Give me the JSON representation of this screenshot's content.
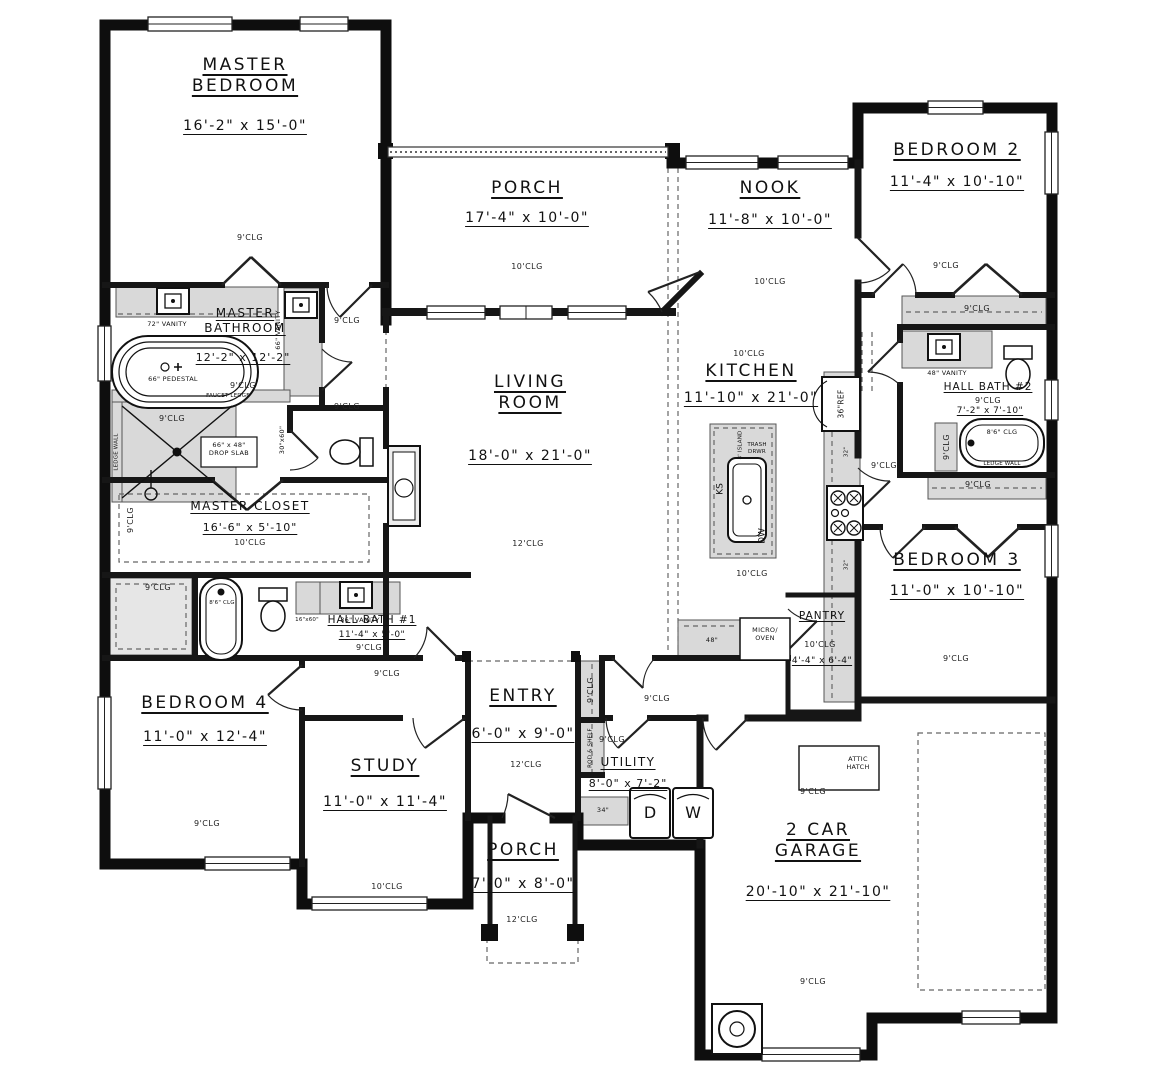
{
  "rooms": {
    "master_bedroom": {
      "name": "MASTER BEDROOM",
      "dims": "16'-2\" x 15'-0\"",
      "clg": "9'CLG"
    },
    "porch_top": {
      "name": "PORCH",
      "dims": "17'-4\" x 10'-0\"",
      "clg": "10'CLG"
    },
    "nook": {
      "name": "NOOK",
      "dims": "11'-8\" x 10'-0\"",
      "clg": "10'CLG"
    },
    "bedroom2": {
      "name": "BEDROOM 2",
      "dims": "11'-4\" x 10'-10\"",
      "clg": "9'CLG"
    },
    "master_bathroom": {
      "name": "MASTER BATHROOM",
      "dims": "12'-2\" x 12'-2\"",
      "clg": "9'CLG"
    },
    "living_room": {
      "name": "LIVING ROOM",
      "dims": "18'-0\" x 21'-0\"",
      "clg": "12'CLG"
    },
    "kitchen": {
      "name": "KITCHEN",
      "dims": "11'-10\" x 21'-0\"",
      "clg": "10'CLG"
    },
    "hall_bath2": {
      "name": "HALL BATH #2",
      "dims": "7'-2\" x 7'-10\"",
      "clg": "9'CLG"
    },
    "master_closet": {
      "name": "MASTER CLOSET",
      "dims": "16'-6\" x 5'-10\"",
      "clg": "10'CLG"
    },
    "bedroom3": {
      "name": "BEDROOM 3",
      "dims": "11'-0\" x 10'-10\"",
      "clg": "9'CLG"
    },
    "hall_bath1": {
      "name": "HALL BATH #1",
      "dims": "11'-4\" x 5'-0\"",
      "clg": "9'CLG"
    },
    "bedroom4": {
      "name": "BEDROOM 4",
      "dims": "11'-0\" x 12'-4\"",
      "clg": "9'CLG"
    },
    "entry": {
      "name": "ENTRY",
      "dims": "6'-0\" x 9'-0\"",
      "clg": "12'CLG"
    },
    "study": {
      "name": "STUDY",
      "dims": "11'-0\" x 11'-4\"",
      "clg": "10'CLG"
    },
    "utility": {
      "name": "UTILITY",
      "dims": "8'-0\" x 7'-2\""
    },
    "pantry": {
      "name": "PANTRY",
      "dims": "4'-4\" x 6'-4\"",
      "clg": "10'CLG"
    },
    "porch_bottom": {
      "name": "PORCH",
      "dims": "7'-0\" x 8'-0\"",
      "clg": "12'CLG"
    },
    "garage": {
      "name": "2 CAR GARAGE",
      "dims": "20'-10\" x 21'-10\"",
      "clg": "9'CLG"
    }
  },
  "misc": {
    "clg9": "9'CLG",
    "clg10": "10'CLG",
    "clg12": "12'CLG",
    "clg86": "8'6\" CLG"
  },
  "fixtures": {
    "vanity72": "72\" VANITY",
    "vanity66": "66\" VANITY",
    "pedestal": "66\" PEDESTAL",
    "faucet_ledge": "FAUCET LEDGE",
    "drop_slab": "66\" x 48\" DROP SLAB",
    "ledge_wall": "LEDGE WALL",
    "wc_size": "30\"x60\"",
    "ref": "36\"REF",
    "ks": "KS",
    "island": "8' ISLAND",
    "trash": "TRASH DRWR",
    "dw": "DW",
    "micro": "MICRO/ OVEN",
    "counter48": "48\"",
    "cab32": "32\"",
    "vanity48": "48\" VANITY",
    "vanity36": "36\" VANITY",
    "linen": "16\"x60\"",
    "rod_shelf": "ROD & SHELF",
    "dryer": "D",
    "washer": "W",
    "counter34": "34\"",
    "attic": "ATTIC HATCH"
  }
}
